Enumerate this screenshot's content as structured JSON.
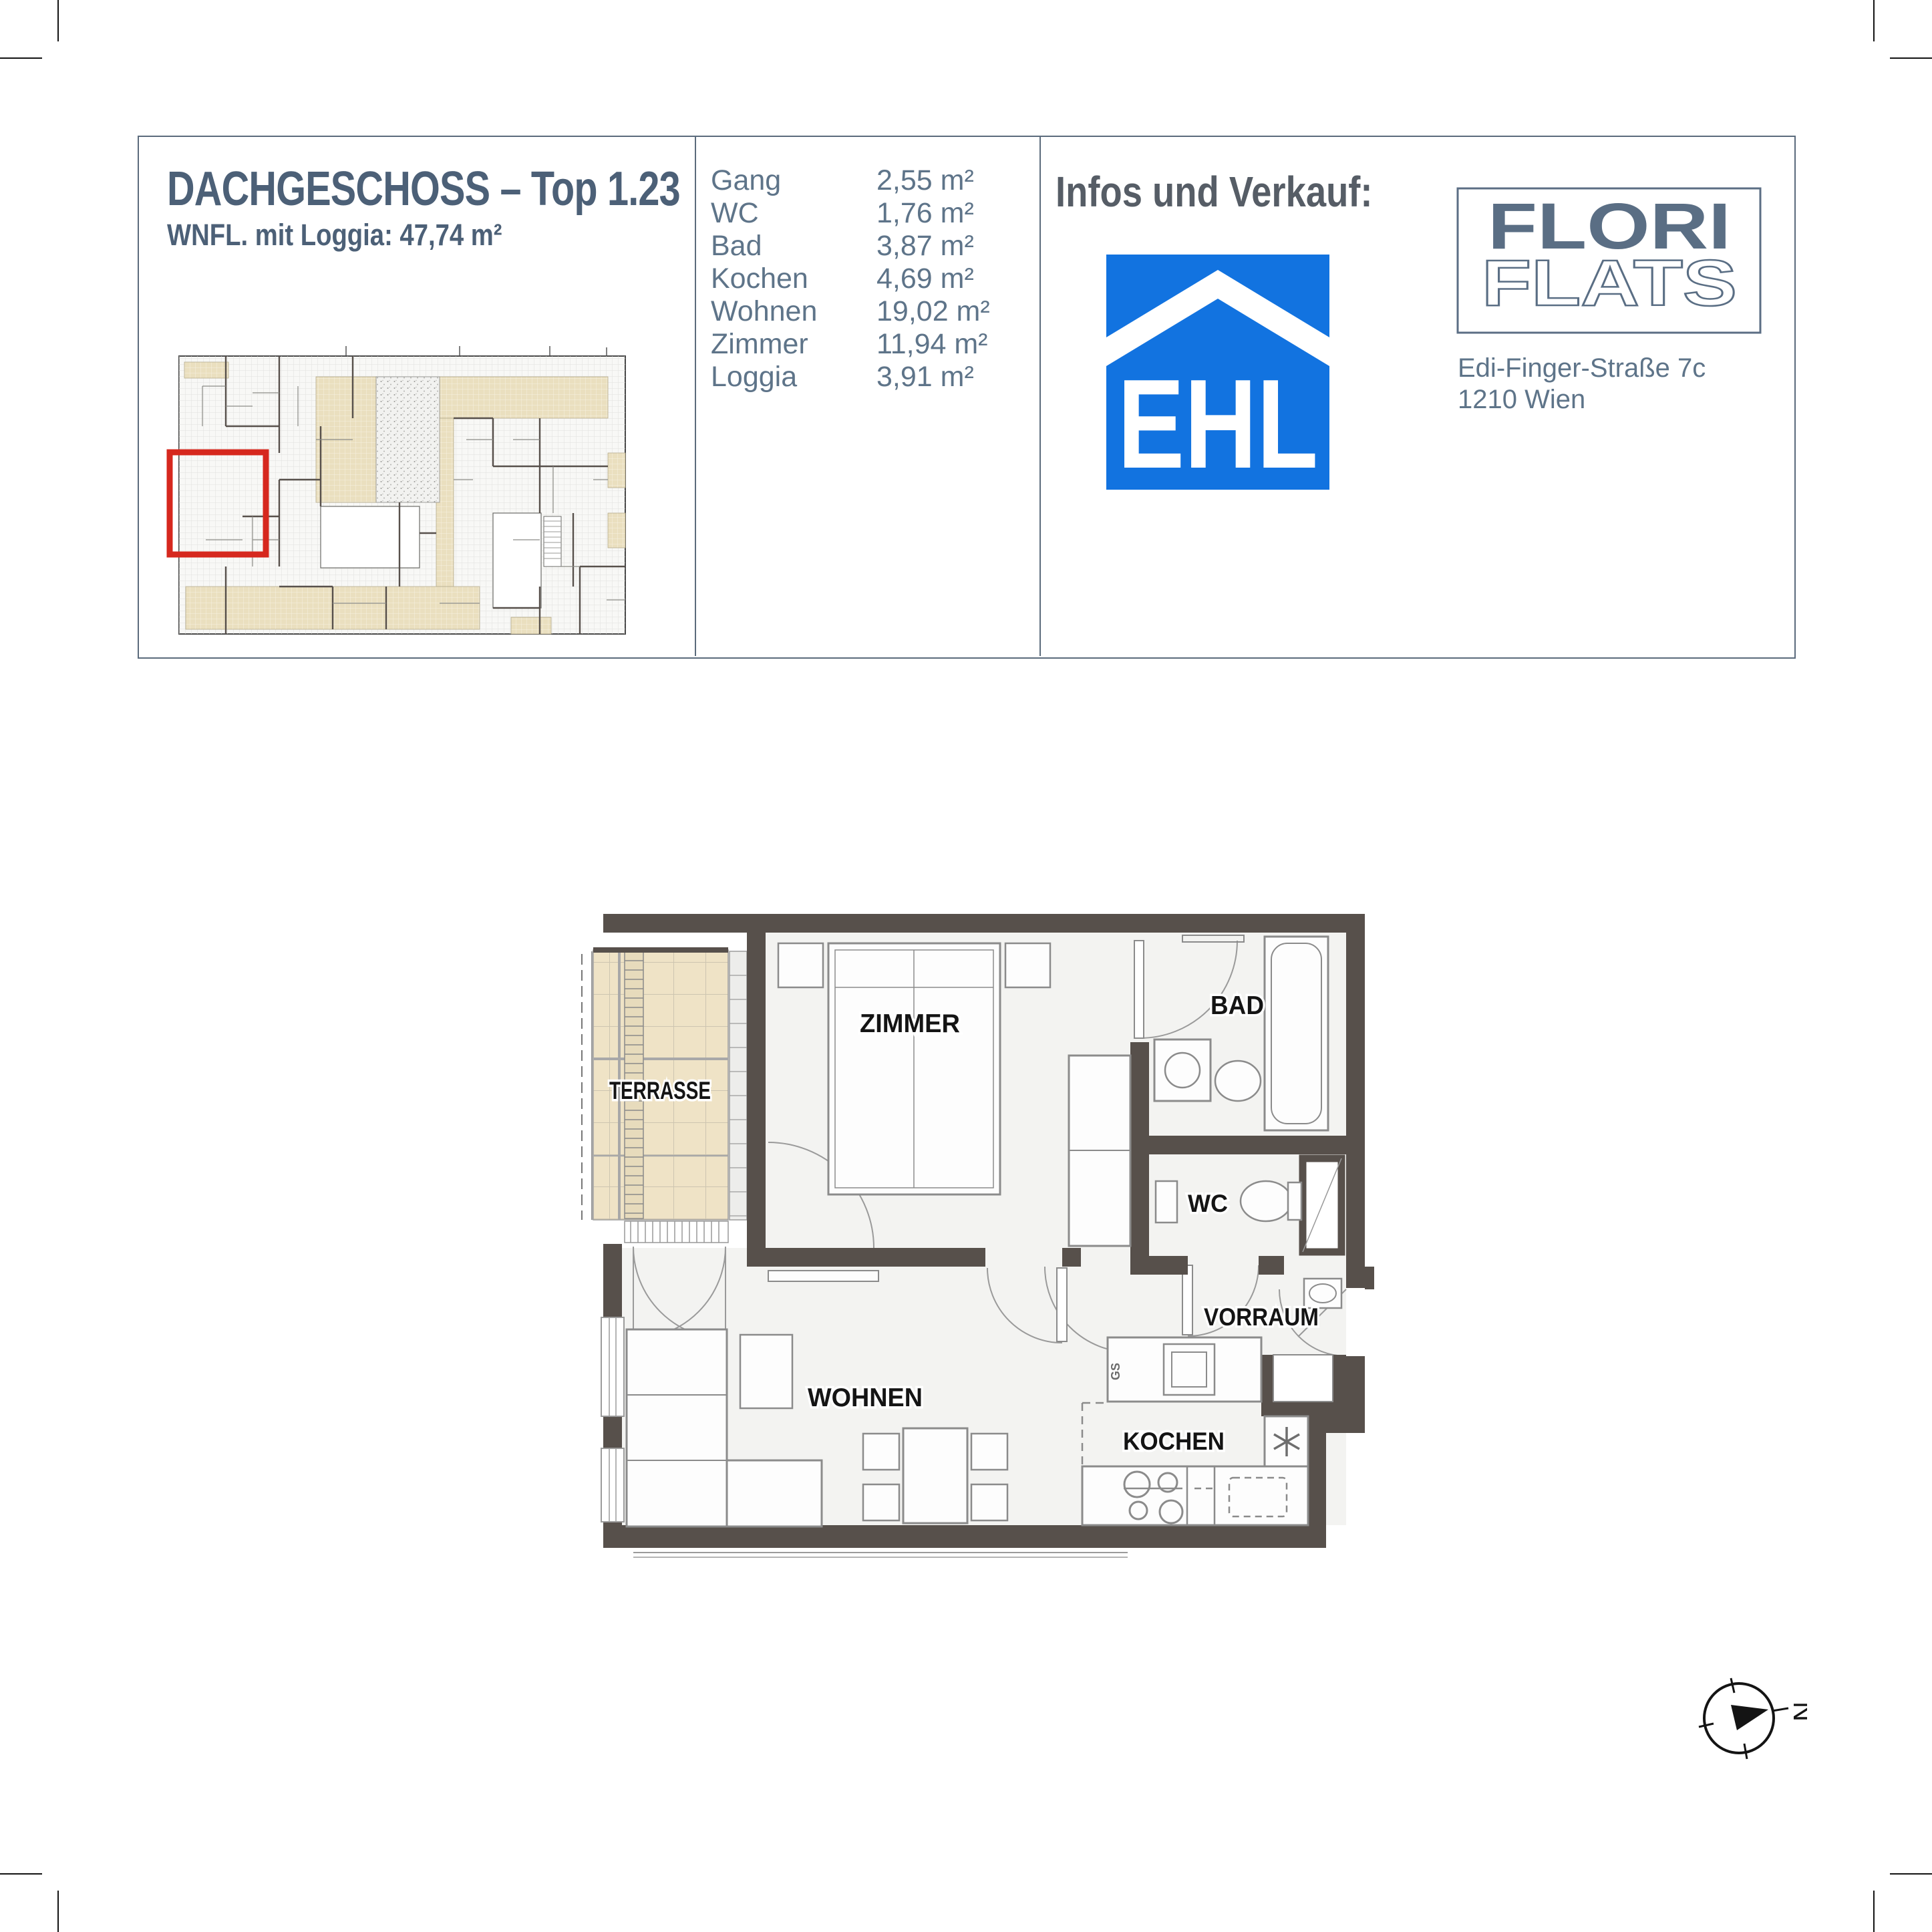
{
  "header": {
    "title": "DACHGESCHOSS – Top 1.23",
    "subtitle": "WNFL. mit Loggia: 47,74 m²",
    "room_table": {
      "rows": [
        {
          "label": "Gang",
          "area": "2,55 m²"
        },
        {
          "label": "WC",
          "area": "1,76 m²"
        },
        {
          "label": "Bad",
          "area": "3,87 m²"
        },
        {
          "label": "Kochen",
          "area": "4,69 m²"
        },
        {
          "label": "Wohnen",
          "area": "19,02 m²"
        },
        {
          "label": "Zimmer",
          "area": "11,94 m²"
        },
        {
          "label": "Loggia",
          "area": "3,91 m²"
        }
      ]
    },
    "sales": {
      "heading": "Infos und Verkauf:",
      "ehl_logo_text": "EHL",
      "brand_word1": "FLORI",
      "brand_word2": "FLATS",
      "address_line1": "Edi-Finger-Straße 7c",
      "address_line2": "1210 Wien"
    }
  },
  "floorplan": {
    "labels": {
      "terrasse": "TERRASSE",
      "zimmer": "ZIMMER",
      "bad": "BAD",
      "wc": "WC",
      "vorraum": "VORRAUM",
      "wohnen": "WOHNEN",
      "kochen": "KOCHEN",
      "dishwasher": "GS"
    },
    "icons": {
      "boiler": "asterisk-icon",
      "north": "compass-icon"
    }
  },
  "compass": {
    "north_label": "N"
  },
  "colors": {
    "accent_blue": "#1273e0",
    "slate_title": "#4c6077",
    "text_muted": "#5e7489",
    "wall": "#57504b",
    "terrace_beige": "#efe3c6",
    "highlight_red": "#d6281e"
  }
}
